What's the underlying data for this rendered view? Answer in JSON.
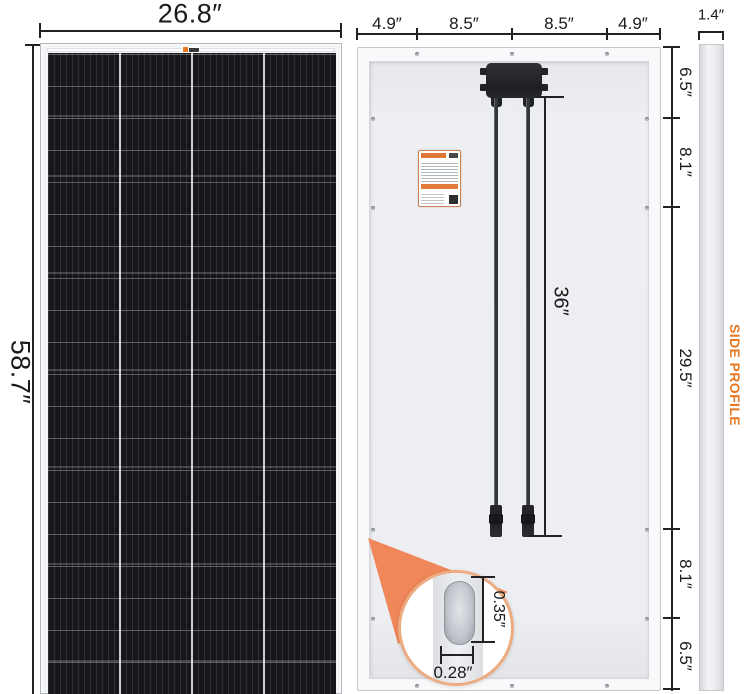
{
  "front_view": {
    "width_label": "26.8″",
    "height_label": "58.7″"
  },
  "back_view": {
    "top_dimensions": [
      "4.9″",
      "8.5″",
      "8.5″",
      "4.9″"
    ],
    "thickness_label": "1.4″",
    "side_dimensions": [
      "6.5″",
      "8.1″",
      "29.5″",
      "8.1″",
      "6.5″"
    ],
    "cable_length_label": "36″",
    "side_profile_label": "SIDE PROFILE"
  },
  "hole_detail": {
    "hole_height_label": "0.35″",
    "hole_width_label": "0.28″"
  },
  "colors": {
    "accent_orange": "#E87722",
    "wedge_orange": "#F0875A",
    "dimension_line": "#222222"
  }
}
